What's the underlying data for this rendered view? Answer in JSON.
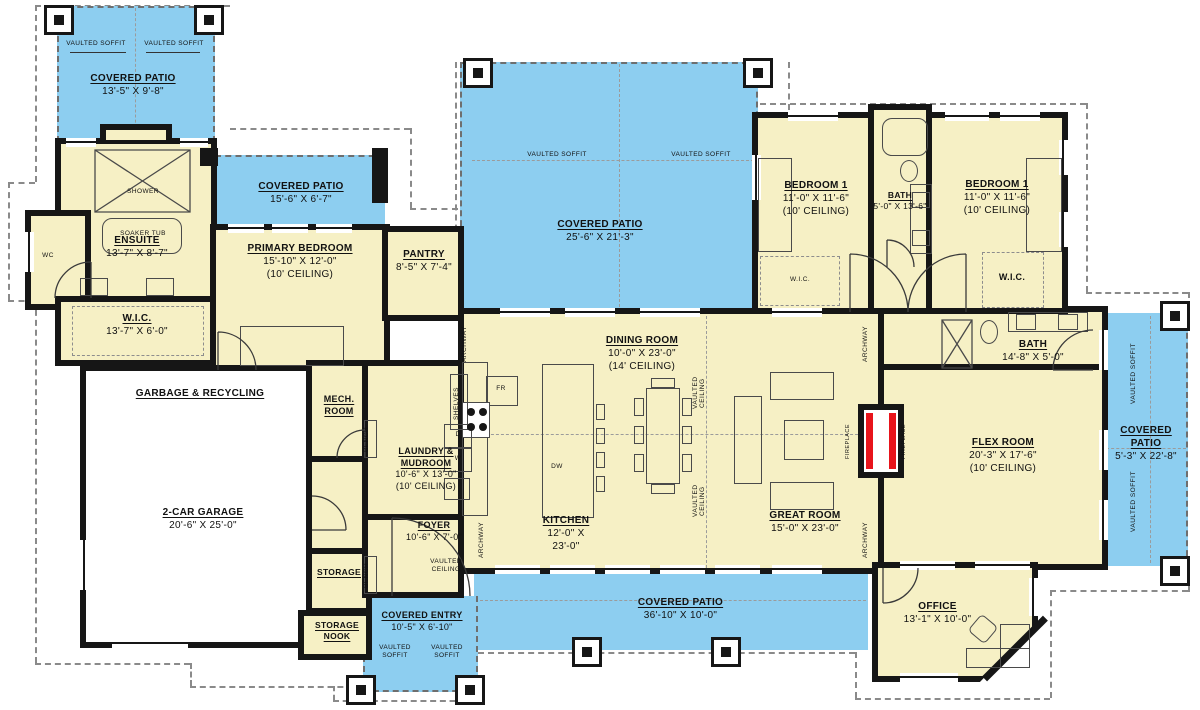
{
  "plan": {
    "title": "Single-story house floor plan",
    "colors": {
      "patio": "#8DCEF0",
      "room": "#F6F0C5",
      "wall": "#161616",
      "fireplace_red": "#E8141B",
      "dash": "#8A8A8A"
    },
    "rooms": {
      "covered_patio_tl": {
        "name": "COVERED PATIO",
        "dims": "13'-5\" X 9'-8\""
      },
      "covered_patio_left": {
        "name": "COVERED PATIO",
        "dims": "15'-6\" X 6'-7\""
      },
      "covered_patio_center": {
        "name": "COVERED PATIO",
        "dims": "25'-6\" X 21'-3\""
      },
      "covered_patio_right": {
        "name": "COVERED PATIO",
        "dims": "5'-3\" X 22'-8\""
      },
      "covered_patio_bottom": {
        "name": "COVERED PATIO",
        "dims": "36'-10\" X 10'-0\""
      },
      "covered_entry": {
        "name": "COVERED ENTRY",
        "dims": "10'-5\" X 6'-10\""
      },
      "ensuite": {
        "name": "ENSUITE",
        "dims": "13'-7\" X 8'-7\""
      },
      "wic_primary": {
        "name": "W.I.C.",
        "dims": "13'-7\" X 6'-0\""
      },
      "primary_bedroom": {
        "name": "PRIMARY BEDROOM",
        "dims": "15'-10\" X 12'-0\"",
        "ceiling": "(10' CEILING)"
      },
      "pantry": {
        "name": "PANTRY",
        "dims": "8'-5\" X 7'-4\""
      },
      "bedroom1_left": {
        "name": "BEDROOM 1",
        "dims": "11'-0\" X 11'-6\"",
        "ceiling": "(10' CEILING)"
      },
      "bath_hall": {
        "name": "BATH",
        "dims": "5'-0\" X 13'-6\""
      },
      "bedroom1_right": {
        "name": "BEDROOM 1",
        "dims": "11'-0\" X 11'-6\"",
        "ceiling": "(10' CEILING)"
      },
      "wic_bed_left": {
        "name": "W.I.C."
      },
      "wic_bed_right": {
        "name": "W.I.C."
      },
      "dining_room": {
        "name": "DINING ROOM",
        "dims": "10'-0\" X 23'-0\"",
        "ceiling": "(14' CEILING)"
      },
      "kitchen": {
        "name": "KITCHEN",
        "dims": "12'-0\" X 23'-0\""
      },
      "great_room": {
        "name": "GREAT ROOM",
        "dims": "15'-0\" X 23'-0\""
      },
      "flex_room": {
        "name": "FLEX ROOM",
        "dims": "20'-3\" X 17'-6\"",
        "ceiling": "(10' CEILING)"
      },
      "bath_flex": {
        "name": "BATH",
        "dims": "14'-8\" X 5'-0\""
      },
      "garage": {
        "name": "2-CAR GARAGE",
        "dims": "20'-6\" X 25'-0\""
      },
      "garbage": {
        "name": "GARBAGE & RECYCLING"
      },
      "mech_room": {
        "name": "MECH. ROOM"
      },
      "laundry": {
        "name": "LAUNDRY & MUDROOM",
        "dims": "10'-6\" X 13'-0\"",
        "ceiling": "(10' CEILING)"
      },
      "foyer": {
        "name": "FOYER",
        "dims": "10'-6\" X 7'-0\""
      },
      "storage": {
        "name": "STORAGE"
      },
      "storage_nook": {
        "name": "STORAGE NOOK"
      },
      "office": {
        "name": "OFFICE",
        "dims": "13'-1\" X 10'-0\""
      }
    },
    "notes": {
      "vaulted_soffit": "VAULTED SOFFIT",
      "vaulted_ceiling": "VAULTED CEILING",
      "archway": "ARCHWAY",
      "fireplace": "FIREPLACE",
      "bench": "BENCH",
      "shelves": "SHELVES",
      "shower": "SHOWER",
      "soaker_tub": "SOAKER TUB",
      "wc": "WC",
      "fr": "FR",
      "dw": "DW",
      "d": "D",
      "w": "W"
    }
  }
}
